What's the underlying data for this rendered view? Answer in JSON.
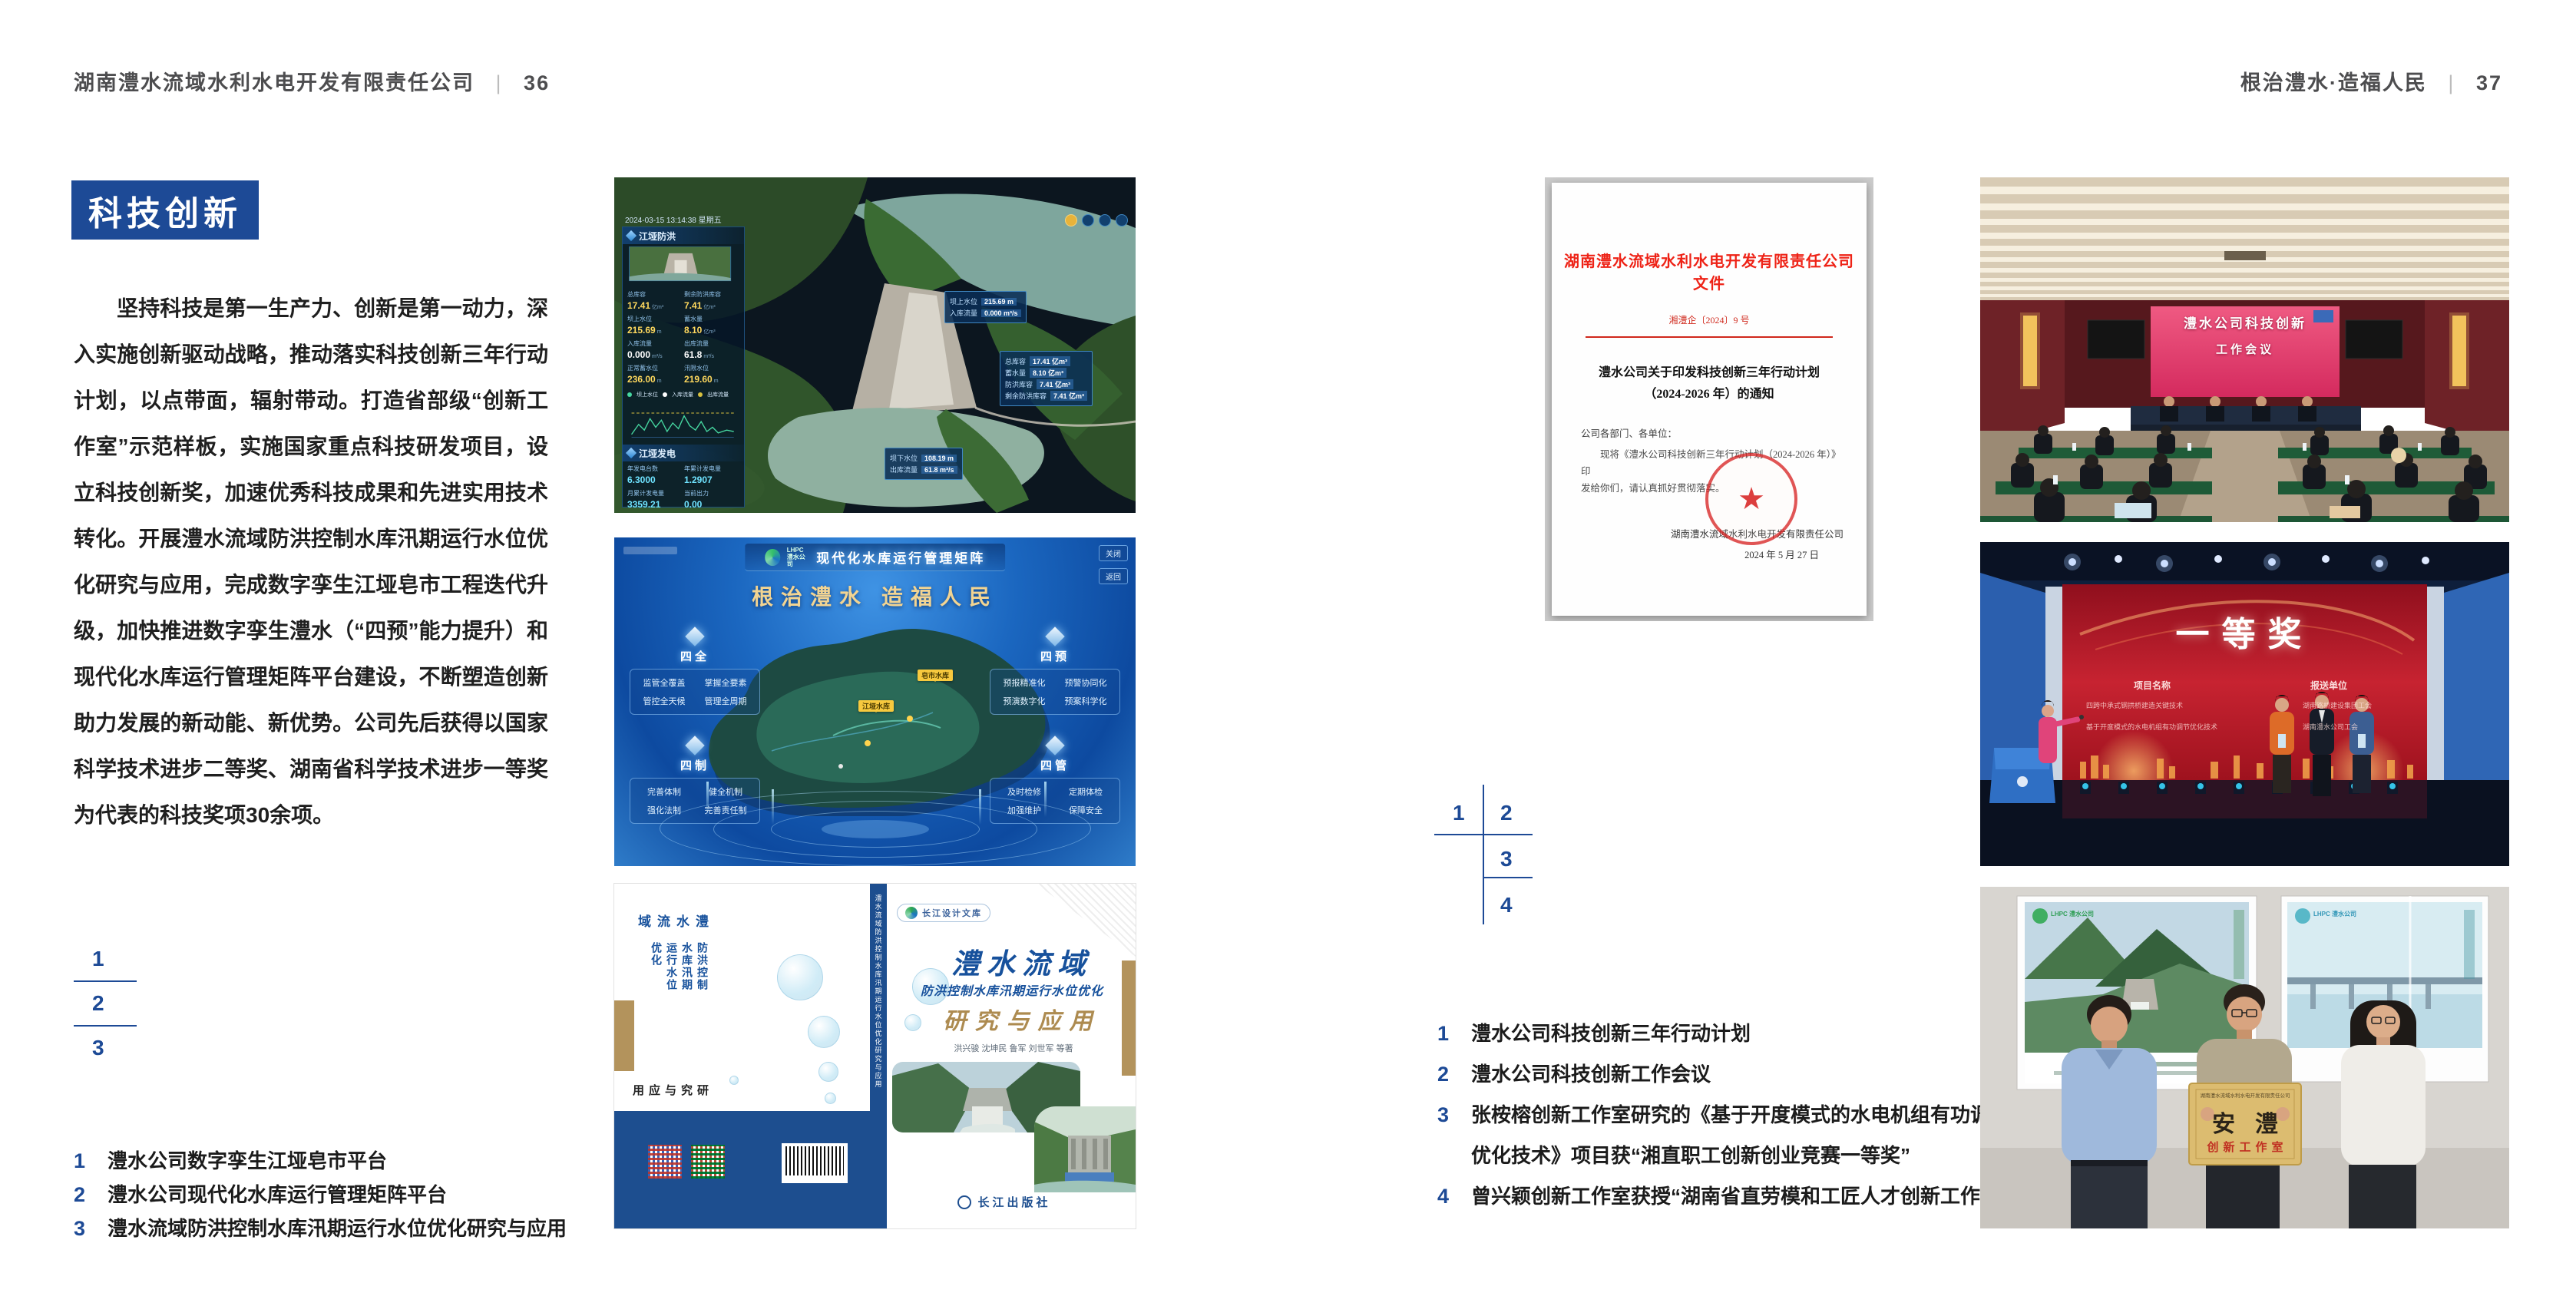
{
  "page_left": {
    "header": {
      "company": "湖南澧水流域水利水电开发有限责任公司",
      "separator": "|",
      "page_no": "36"
    },
    "section_title": "科技创新",
    "body": "坚持科技是第一生产力、创新是第一动力，深入实施创新驱动战略，推动落实科技创新三年行动计划，以点带面，辐射带动。打造省部级“创新工作室”示范样板，实施国家重点科技研发项目，设立科技创新奖，加速优秀科技成果和先进实用技术转化。开展澧水流域防洪控制水库汛期运行水位优化研究与应用，完成数字孪生江垭皂市工程迭代升级，加快推进数字孪生澧水（“四预”能力提升）和现代化水库运行管理矩阵平台建设，不断塑造创新助力发展的新动能、新优势。公司先后获得以国家科学技术进步二等奖、湖南省科学技术进步一等奖为代表的科技奖项30余项。",
    "figure_nums": [
      "1",
      "2",
      "3"
    ],
    "captions": [
      {
        "num": "1",
        "text": "澧水公司数字孪生江垭皂市平台"
      },
      {
        "num": "2",
        "text": "澧水公司现代化水库运行管理矩阵平台"
      },
      {
        "num": "3",
        "text": "澧水流域防洪控制水库汛期运行水位优化研究与应用"
      }
    ]
  },
  "page_right": {
    "header": {
      "motto": "根治澧水·造福人民",
      "separator": "|",
      "page_no": "37"
    },
    "figure_nums": [
      "1",
      "2",
      "3",
      "4"
    ],
    "captions": [
      {
        "num": "1",
        "text": "澧水公司科技创新三年行动计划"
      },
      {
        "num": "2",
        "text": "澧水公司科技创新工作会议"
      },
      {
        "num": "3",
        "text": "张桉榕创新工作室研究的《基于开度模式的水电机组有功调节优化技术》项目获“湘直职工创新创业竞赛一等奖”"
      },
      {
        "num": "4",
        "text": "曾兴颖创新工作室获授“湖南省直劳模和工匠人才创新工作室”"
      }
    ]
  },
  "dashboard": {
    "brand": "防洪兴利调度",
    "title": "数字孪生江垭皂市",
    "tabs_left": [
      "实时监测",
      "洪水预报",
      "防洪预警"
    ],
    "tabs_right": [
      "风险预判",
      "预案生成",
      "调度执行",
      "工程巡检"
    ],
    "timestamp": "2024-03-15 13:14:38 星期五",
    "panel_flood": {
      "title": "江垭防洪",
      "stats": [
        {
          "label": "总库容",
          "value": "17.41",
          "unit": "亿m³"
        },
        {
          "label": "剩余防洪库容",
          "value": "7.41",
          "unit": "亿m³"
        },
        {
          "label": "坝上水位",
          "value": "215.69",
          "unit": "m"
        },
        {
          "label": "蓄水量",
          "value": "8.10",
          "unit": "亿m³"
        },
        {
          "label": "入库流量",
          "value": "0.000",
          "unit": "m³/s"
        },
        {
          "label": "出库流量",
          "value": "61.8",
          "unit": "m³/s"
        },
        {
          "label": "正常蓄水位",
          "value": "236.00",
          "unit": "m"
        },
        {
          "label": "汛限水位",
          "value": "219.60",
          "unit": "m"
        }
      ]
    },
    "legend": [
      "坝上水位",
      "入库流量",
      "出库流量"
    ],
    "panel_power": {
      "title": "江垭发电",
      "stats": [
        {
          "label": "年发电台数",
          "value": "6.3000"
        },
        {
          "label": "年累计发电量",
          "value": "1.2907"
        },
        {
          "label": "月累计发电量",
          "value": "3359.21"
        },
        {
          "label": "当前出力",
          "value": "0.00"
        }
      ]
    },
    "callout_up": {
      "label1": "坝上水位",
      "value1": "215.69 m",
      "label2": "入库流量",
      "value2": "0.000 m³/s"
    },
    "callout_store": [
      {
        "label": "总库容",
        "value": "17.41 亿m³"
      },
      {
        "label": "蓄水量",
        "value": "8.10 亿m³"
      },
      {
        "label": "防洪库容",
        "value": "7.41 亿m³"
      },
      {
        "label": "剩余防洪库容",
        "value": "7.41 亿m³"
      }
    ],
    "callout_down": {
      "label1": "坝下水位",
      "value1": "108.19 m",
      "label2": "出库流量",
      "value2": "61.8 m³/s"
    }
  },
  "matrix": {
    "logo_line1": "LHPC",
    "logo_line2": "澧水公司",
    "title": "现代化水库运行管理矩阵",
    "slogan": "根治澧水 造福人民",
    "buttons": [
      "关闭",
      "返回"
    ],
    "markers": [
      "皂市水库",
      "江垭水库"
    ],
    "panels": [
      {
        "title": "四全",
        "items": [
          "监管全覆盖",
          "掌握全要素",
          "管控全天候",
          "管理全周期"
        ]
      },
      {
        "title": "四预",
        "items": [
          "预报精准化",
          "预警协同化",
          "预演数字化",
          "预案科学化"
        ]
      },
      {
        "title": "四制",
        "items": [
          "完善体制",
          "健全机制",
          "强化法制",
          "完善责任制"
        ]
      },
      {
        "title": "四管",
        "items": [
          "及时检修",
          "定期体检",
          "加强维护",
          "保障安全"
        ]
      }
    ]
  },
  "book": {
    "series_badge": "长江设计文库",
    "title1": "澧水流域",
    "title2": "防洪控制水库汛期运行水位优化",
    "title3": "研究与应用",
    "authors": "洪兴骏  沈坤民  鲁军  刘世军  等著",
    "publisher": "长江出版社",
    "spine_text": "澧水流域防洪控制水库汛期运行水位优化研究与应用",
    "back": {
      "line1": "澧水流域",
      "line2": "防洪控制水库汛期运行水位优化",
      "line3": "研究与应用"
    }
  },
  "document": {
    "header": "湖南澧水流域水利水电开发有限责任公司文件",
    "doc_no": "湘澧企〔2024〕9 号",
    "title_line1": "澧水公司关于印发科技创新三年行动计划",
    "title_line2": "（2024-2026 年）的通知",
    "salutation": "公司各部门、各单位：",
    "body_line1": "现将《澧水公司科技创新三年行动计划（2024-2026 年）》印",
    "body_line2": "发给你们，请认真抓好贯彻落实。",
    "signer": "湖南澧水流域水利水电开发有限责任公司",
    "date": "2024 年 5 月 27 日"
  },
  "meeting": {
    "screen_line1": "澧水公司科技创新",
    "screen_line2": "工作会议"
  },
  "award": {
    "screen_title": "一等奖",
    "col1": "项目名称",
    "col2": "报送单位",
    "rows": [
      {
        "project": "四跨中承式钢拱桥建造关键技术",
        "unit": "湖南路桥建设集团工会"
      },
      {
        "project": "基于开度模式的水电机组有功调节优化技术",
        "unit": "湖南澧水公司工会"
      }
    ]
  },
  "plaque": {
    "org_line": "湖南澧水流域水利水电开发有限责任公司",
    "name": "安澧",
    "subtitle": "创新工作室",
    "poster_logo": "LHPC 澧水公司"
  }
}
